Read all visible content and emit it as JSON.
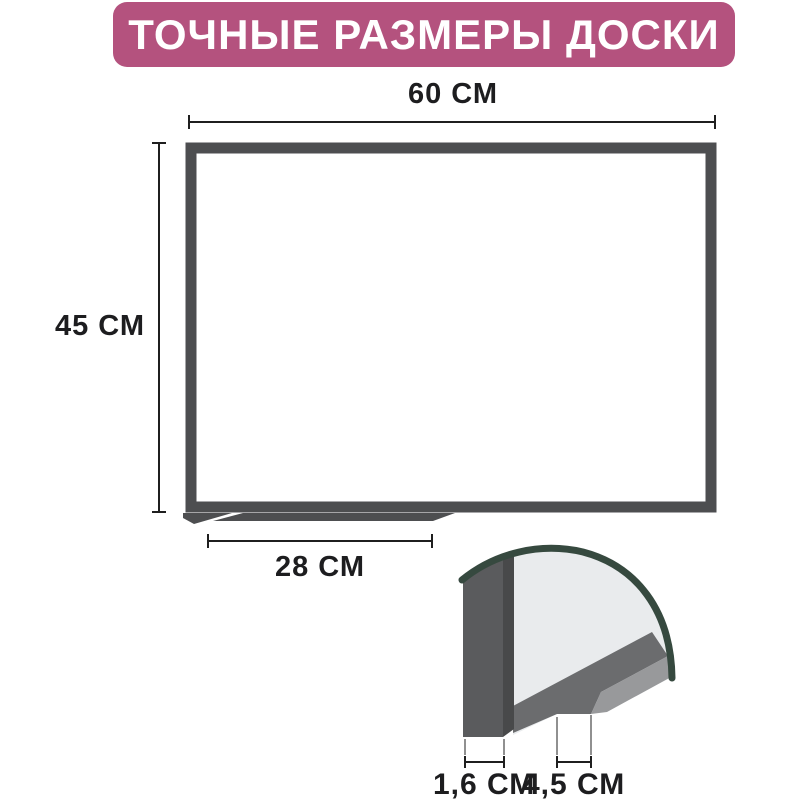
{
  "title": {
    "text": "ТОЧНЫЕ РАЗМЕРЫ ДОСКИ"
  },
  "board_diagram": {
    "description": "whiteboard front view with dimension arrows",
    "width_label": "60 СМ",
    "height_label": "45 СМ",
    "tray_width_label": "28 СМ"
  },
  "cross_section": {
    "description": "magnified corner profile of board frame and pen tray",
    "frame_thickness_label": "1,6 СМ",
    "tray_depth_label": "4,5 СМ"
  },
  "colors": {
    "banner_background": "#b4527e",
    "banner_text": "#ffffff",
    "frame_gray": "#4d4e50",
    "dimension_line": "#1f1f1f",
    "label_text": "#1d1d1f",
    "profile_slab": "#5a5b5d",
    "profile_shadow_strip": "#48494a",
    "profile_surface": "#e9ebed",
    "profile_band_dark": "#6b6c6e",
    "profile_band_light": "#98999b",
    "lens_arc_teal": "#36493f",
    "page_background": "#ffffff"
  }
}
